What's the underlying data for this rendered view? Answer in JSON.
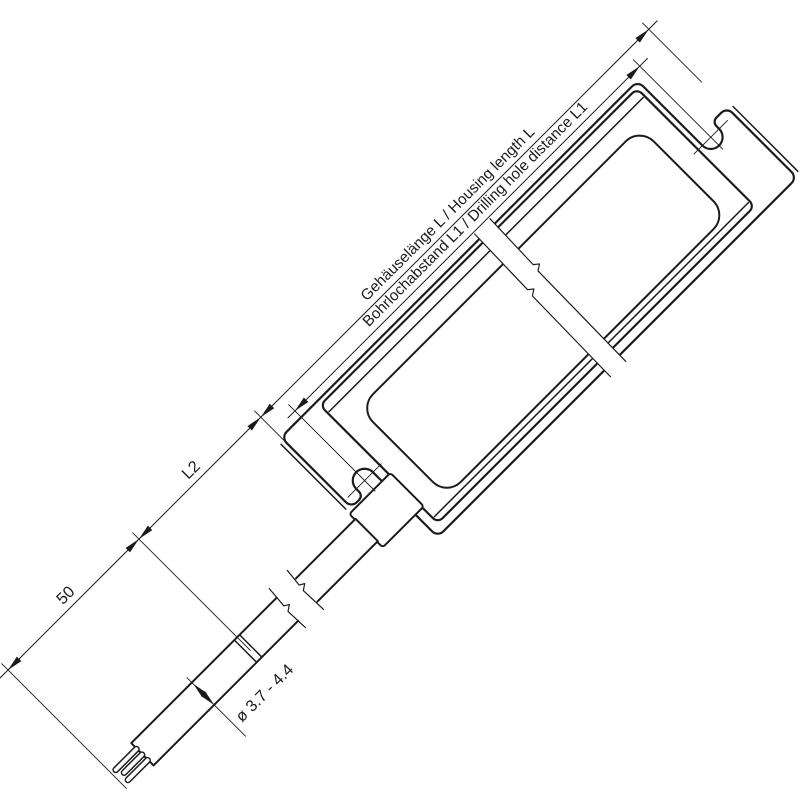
{
  "drawing": {
    "type": "technical-dimension-drawing",
    "labels": {
      "housing_length": "Gehäuselänge L / Housing length L",
      "hole_distance": "Bohrlochabstand L1 / Drilling hole distance L1",
      "cable_section_length": "L2",
      "strip_length": "50",
      "cable_diameter": "ø 3.7 - 4.4"
    },
    "colors": {
      "line": "#1a1a1a",
      "background": "#ffffff"
    }
  }
}
